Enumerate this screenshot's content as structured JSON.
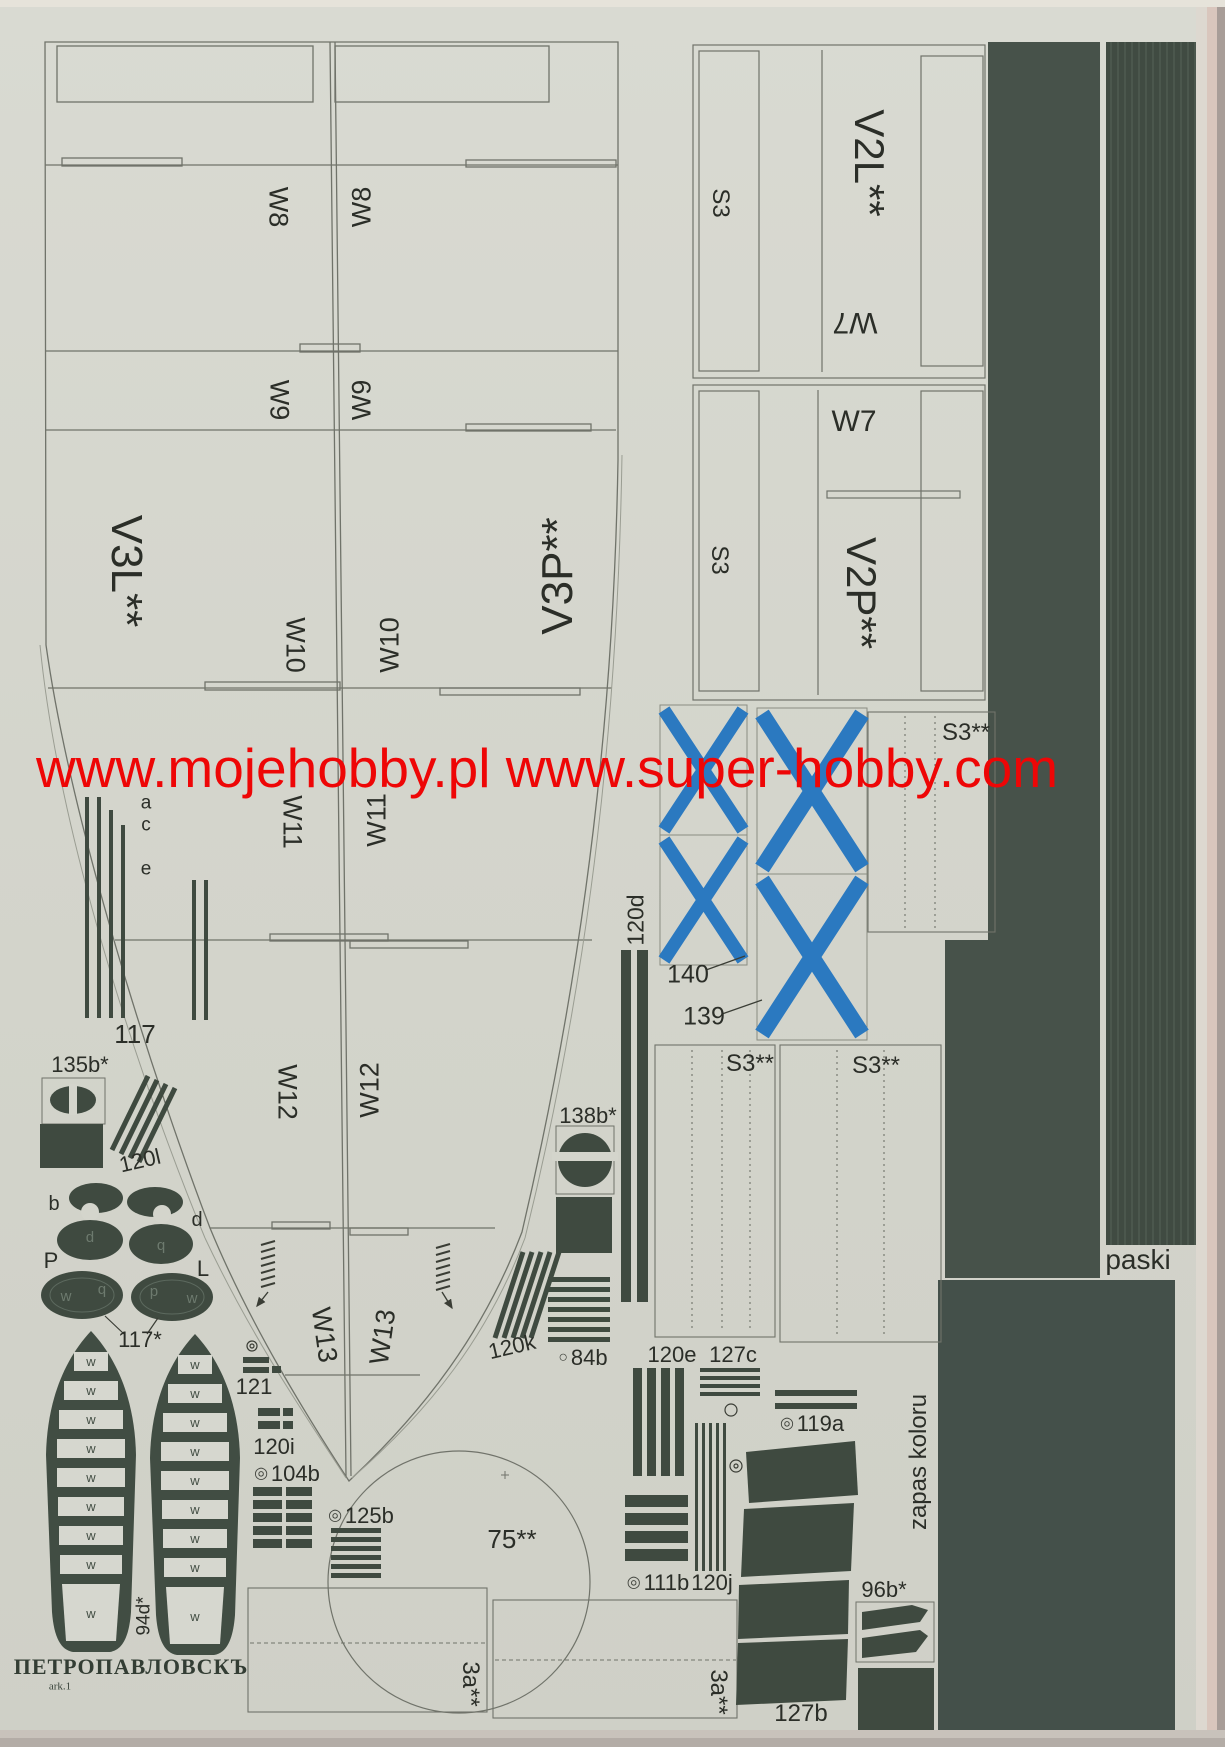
{
  "watermark": {
    "text": "www.mojehobby.pl www.super-hobby.com",
    "color": "#ee0606"
  },
  "colors": {
    "dark_green": "#414d43",
    "flag_blue": "#2b79c0",
    "paper": "#d4d5cc",
    "watermark_red": "#ee0606"
  },
  "icons": {
    "ring": "◎",
    "dot": "○"
  },
  "hull": {
    "left_part_label": "V3L**",
    "right_part_label": "V3P**",
    "rows": [
      {
        "left": "W8",
        "right": "W8"
      },
      {
        "left": "W9",
        "right": "W9"
      },
      {
        "left": "W10",
        "right": "W10"
      },
      {
        "left": "W11",
        "right": "W11"
      },
      {
        "left": "W12",
        "right": "W12"
      },
      {
        "left": "W13",
        "right": "W13"
      }
    ]
  },
  "right_sheet": {
    "block1": {
      "strip": "S3",
      "main": "V2L**",
      "tab": "W7"
    },
    "block2": {
      "strip": "S3",
      "main": "V2P**",
      "tab": "W7"
    },
    "s3_panel": "S3**",
    "s3_bottom_left": "S3**",
    "s3_bottom_right": "S3**"
  },
  "flags": {
    "small": "140",
    "large": "139"
  },
  "parts": {
    "p117": "117",
    "letter_a": "a",
    "letter_c": "c",
    "letter_e": "e",
    "p135b": "135b*",
    "p120l": "120l",
    "letter_b": "b",
    "letter_d": "d",
    "letter_P": "P",
    "letter_L": "L",
    "p117s": "117*",
    "p94d": "94d*",
    "p121": "121",
    "p120i": "120i",
    "p104b": "104b",
    "p125b": "125b",
    "p138b": "138b*",
    "p120k": "120k",
    "p84b": "84b",
    "p120d": "120d",
    "p75": "75**",
    "p120e": "120e",
    "p127c": "127c",
    "p119a": "119a",
    "p111b": "111b",
    "p120j": "120j",
    "p96b": "96b*",
    "p127b": "127b",
    "p3a_left": "3a**",
    "p3a_right": "3a**",
    "rung_letter": "w",
    "ellipse_letters": {
      "small_left": "p",
      "small_right": "q",
      "big_left_a": "w",
      "big_left_b": "b",
      "big_right_a": "d",
      "big_right_b": "w"
    }
  },
  "margin_labels": {
    "zapas": "zapas koloru",
    "paski": "paski"
  },
  "footer": {
    "ship_name": "ПЕТРОПАВЛОВСКЪ",
    "sheet_note": "ark.1"
  }
}
